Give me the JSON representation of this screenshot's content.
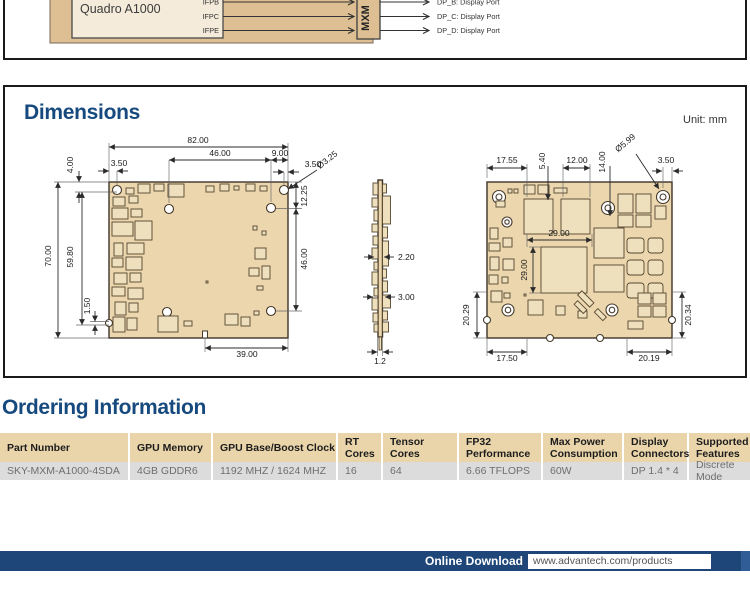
{
  "block_diagram": {
    "gpu_label": "Quadro A1000",
    "ports": {
      "b": "IFPB",
      "c": "IFPC",
      "e": "IFPE"
    },
    "connector_label": "MXM",
    "outputs": {
      "b": "DP_B: Display Port",
      "c": "DP_C: Display Port",
      "d": "DP_D: Display Port"
    }
  },
  "dimensions": {
    "title": "Dimensions",
    "unit_label": "Unit: mm",
    "front": {
      "total_width": "82.00",
      "hole_span": "46.00",
      "hole_right": "9.00",
      "edge_left": "3.50",
      "edge_right": "3.50",
      "hole_dia": "Ø3.25",
      "top_offset": "4.00",
      "total_height": "70.00",
      "inner_height": "59.80",
      "notch": "1.50",
      "right_top": "12.25",
      "right_span": "46.00",
      "bottom_width": "39.00"
    },
    "side": {
      "comp_top": "2.20",
      "comp_bottom": "3.00",
      "thickness": "1.2"
    },
    "back": {
      "top_left": "17.55",
      "comp_offset": "5.40",
      "comp_width": "12.00",
      "hole_offset": "14.00",
      "hole_dia": "Ø5.99",
      "edge_right": "3.50",
      "chip_width": "29.00",
      "chip_height": "29.00",
      "left_height": "20.29",
      "right_height": "20.34",
      "bottom_left": "17.50",
      "bottom_right": "20.19"
    }
  },
  "ordering": {
    "title": "Ordering Information",
    "columns": [
      "Part Number",
      "GPU Memory",
      "GPU Base/Boost Clock",
      "RT\nCores",
      "Tensor\nCores",
      "FP32\nPerformance",
      "Max Power\nConsumption",
      "Display\nConnectors",
      "Supported\nFeatures"
    ],
    "row": [
      "SKY-MXM-A1000-4SDA",
      "4GB GDDR6",
      "1192 MHZ / 1624 MHZ",
      "16",
      "64",
      "6.66 TFLOPS",
      "60W",
      "DP 1.4 * 4",
      "Discrete Mode"
    ]
  },
  "footer": {
    "download_label": "Online Download",
    "url": "www.advantech.com/products"
  },
  "colors": {
    "accent_blue": "#164a7e",
    "footer_navy": "#1e4679",
    "board_tan": "#ebd6ad",
    "diagram_tan": "#debf93",
    "table_header_tan": "#ead5ab",
    "table_row_gray": "#dcdcdc"
  }
}
